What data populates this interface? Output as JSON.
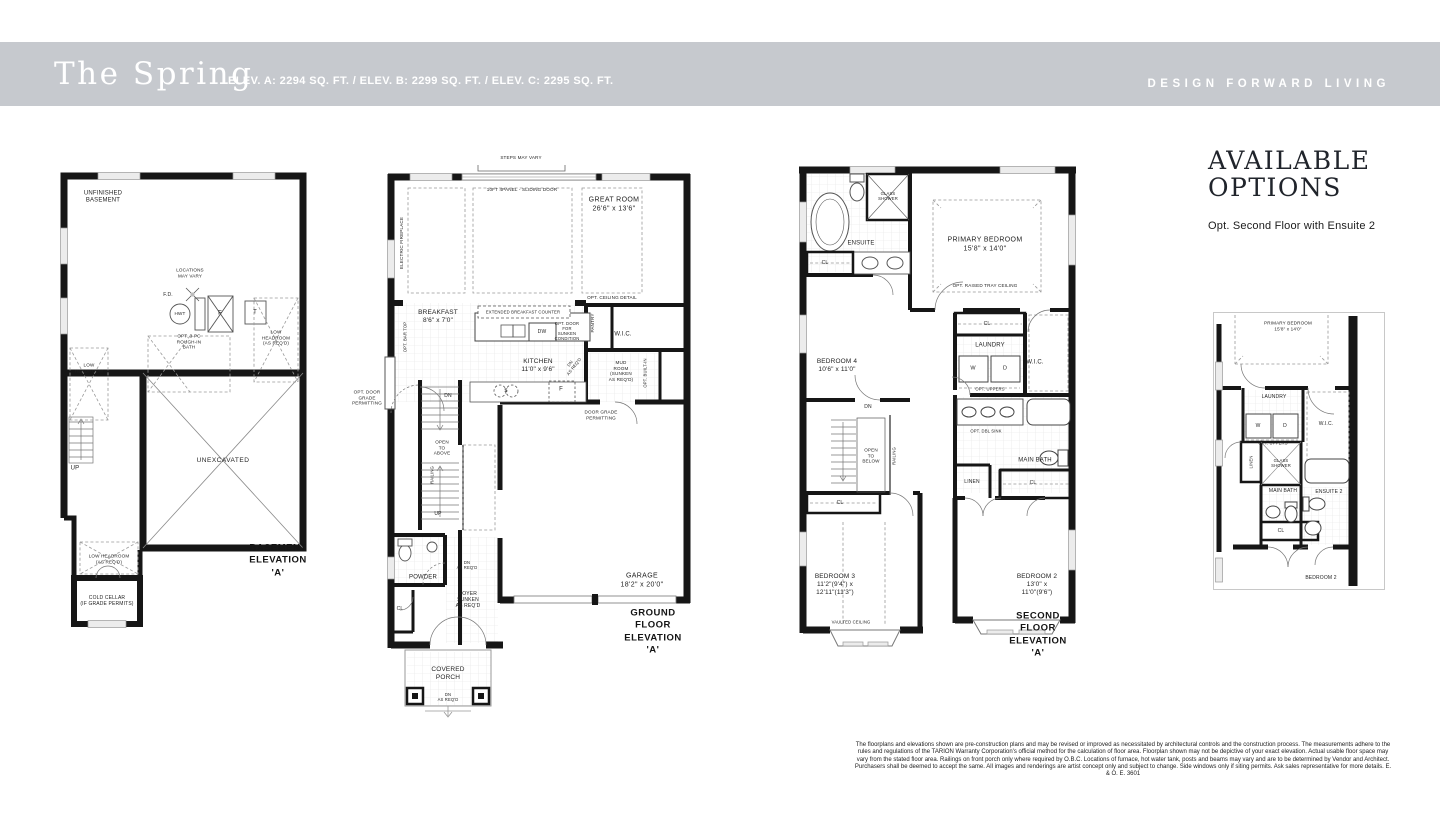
{
  "header": {
    "title": "The Spring",
    "specs": "ELEV. A: 2294 SQ. FT. / ELEV. B: 2299 SQ. FT. / ELEV. C: 2295 SQ. FT.",
    "tagline": "DESIGN FORWARD LIVING"
  },
  "basement": {
    "caption": "BASEMENT\nELEVATION 'A'",
    "labels": {
      "unfinished": "UNFINISHED\nBASEMENT",
      "locations": "LOCATIONS\nMAY VARY",
      "fd": "F.D.",
      "hwt": "HWT",
      "furnace": "F",
      "tank": "T",
      "roughin": "OPT. 3-PC\nROUGH-IN\nBATH",
      "lowhead_right": "LOW HEADROOM\n(AS REQ'D)",
      "lowhead_left": "LOW\nHEADROOM",
      "up": "UP",
      "unexcavated": "UNEXCAVATED",
      "lowhead_bottom": "LOW HEADROOM\n(AS REQ'D)",
      "cold_cellar": "COLD CELLAR\n(IF GRADE PERMITS)"
    }
  },
  "ground": {
    "caption": "GROUND FLOOR\nELEVATION 'A'",
    "labels": {
      "steps": "STEPS MAY VARY",
      "sliding_door": "10FT 4PANEL - SLIDING DOOR",
      "great_room": "GREAT ROOM\n26'6\" x 13'6\"",
      "fireplace": "ELECTRIC FIREPLACE",
      "ceiling_detail": "OPT. CEILING DETAIL",
      "breakfast": "BREAKFAST\n8'6\" x 7'0\"",
      "bar_top": "OPT. BAR TOP",
      "counter": "EXTENDED BREAKFAST COUNTER",
      "dw": "DW",
      "sunken_door": "OPT. DOOR\nFOR\nSUNKEN\nCONDITION",
      "pantry": "PANTRY",
      "wic": "W.I.C.",
      "kitchen": "KITCHEN\n11'0\" x 9'6\"",
      "dn_diag": "DN\nAS REQ'D",
      "mud_room": "MUD\nROOM\n(SUNKEN\nAS REQ'D)",
      "built_in": "OPT. BUILT-IN",
      "sink": "S",
      "fridge": "F",
      "door_grade": "DOOR GRADE\nPERMITTING",
      "opt_door_grade": "OPT. DOOR\nGRADE\nPERMITTING",
      "dn": "DN",
      "open_above": "OPEN\nTO\nABOVE",
      "railing": "RAILING",
      "up": "UP",
      "powder": "POWDER",
      "dn_req": "DN\nAS REQ'D",
      "foyer": "FOYER\nSUNKEN\nAS REQ'D",
      "cl": "CL",
      "garage": "GARAGE\n18'2\" x 20'0\"",
      "porch": "COVERED\nPORCH",
      "porch_dn": "DN\nAS REQ'D"
    }
  },
  "second": {
    "caption": "SECOND FLOOR\nELEVATION 'A'",
    "labels": {
      "glass_shower": "GLASS\nSHOWER",
      "ensuite": "ENSUITE",
      "cl1": "CL",
      "primary": "PRIMARY BEDROOM\n15'8\" x 14'0\"",
      "tray": "OPT. RAISED TRAY CEILING",
      "bedroom4": "BEDROOM 4\n10'6\" x 11'0\"",
      "cl2": "CL",
      "laundry": "LAUNDRY",
      "wic": "W.I.C.",
      "washer": "W",
      "dryer": "D",
      "uppers": "OPT. UPPERS",
      "dn": "DN",
      "open_below": "OPEN\nTO\nBELOW",
      "railing": "RAILING",
      "dbl_sink": "OPT. DBL SINK",
      "main_bath": "MAIN BATH",
      "cl3": "CL",
      "linen": "LINEN",
      "cl4": "CL",
      "bedroom3": "BEDROOM 3\n11'2\"(9'4\") x\n12'11\"(11'3\")",
      "vaulted": "VAULTED CEILING",
      "bedroom2": "BEDROOM 2\n13'0\" x\n11'0\"(9'6\")"
    }
  },
  "options": {
    "title": "AVAILABLE\nOPTIONS",
    "subtitle": "Opt. Second Floor with Ensuite 2",
    "labels": {
      "primary": "PRIMARY BEDROOM\n15'8\" x 14'0\"",
      "laundry": "LAUNDRY",
      "washer": "W",
      "dryer": "D",
      "uppers": "OPT. UPPERS",
      "wic": "W.I.C.",
      "linen": "LINEN",
      "glass_shower": "GLASS\nSHOWER",
      "main_bath": "MAIN BATH",
      "ensuite2": "ENSUITE 2",
      "cl": "CL",
      "bedroom2": "BEDROOM 2"
    }
  },
  "disclaimer": "The floorplans and elevations shown are pre-construction plans and may be revised or improved as necessitated by architectural controls and the construction process. The measurements adhere to the rules and regulations of the TARION Warranty Corporation's official method for the calculation of floor area. Floorplan shown may not be depictive of your exact elevation. Actual usable floor space may vary from the stated floor area. Railings on front porch only where required by O.B.C. Locations of furnace, hot water tank, posts and beams may vary and are to be determined by Vendor and Architect. Purchasers shall be deemed to accept the same. All images and renderings are artist concept only and subject to change. Side windows only if siting permits. Ask sales representative for more details. E. & O. E. 3601"
}
